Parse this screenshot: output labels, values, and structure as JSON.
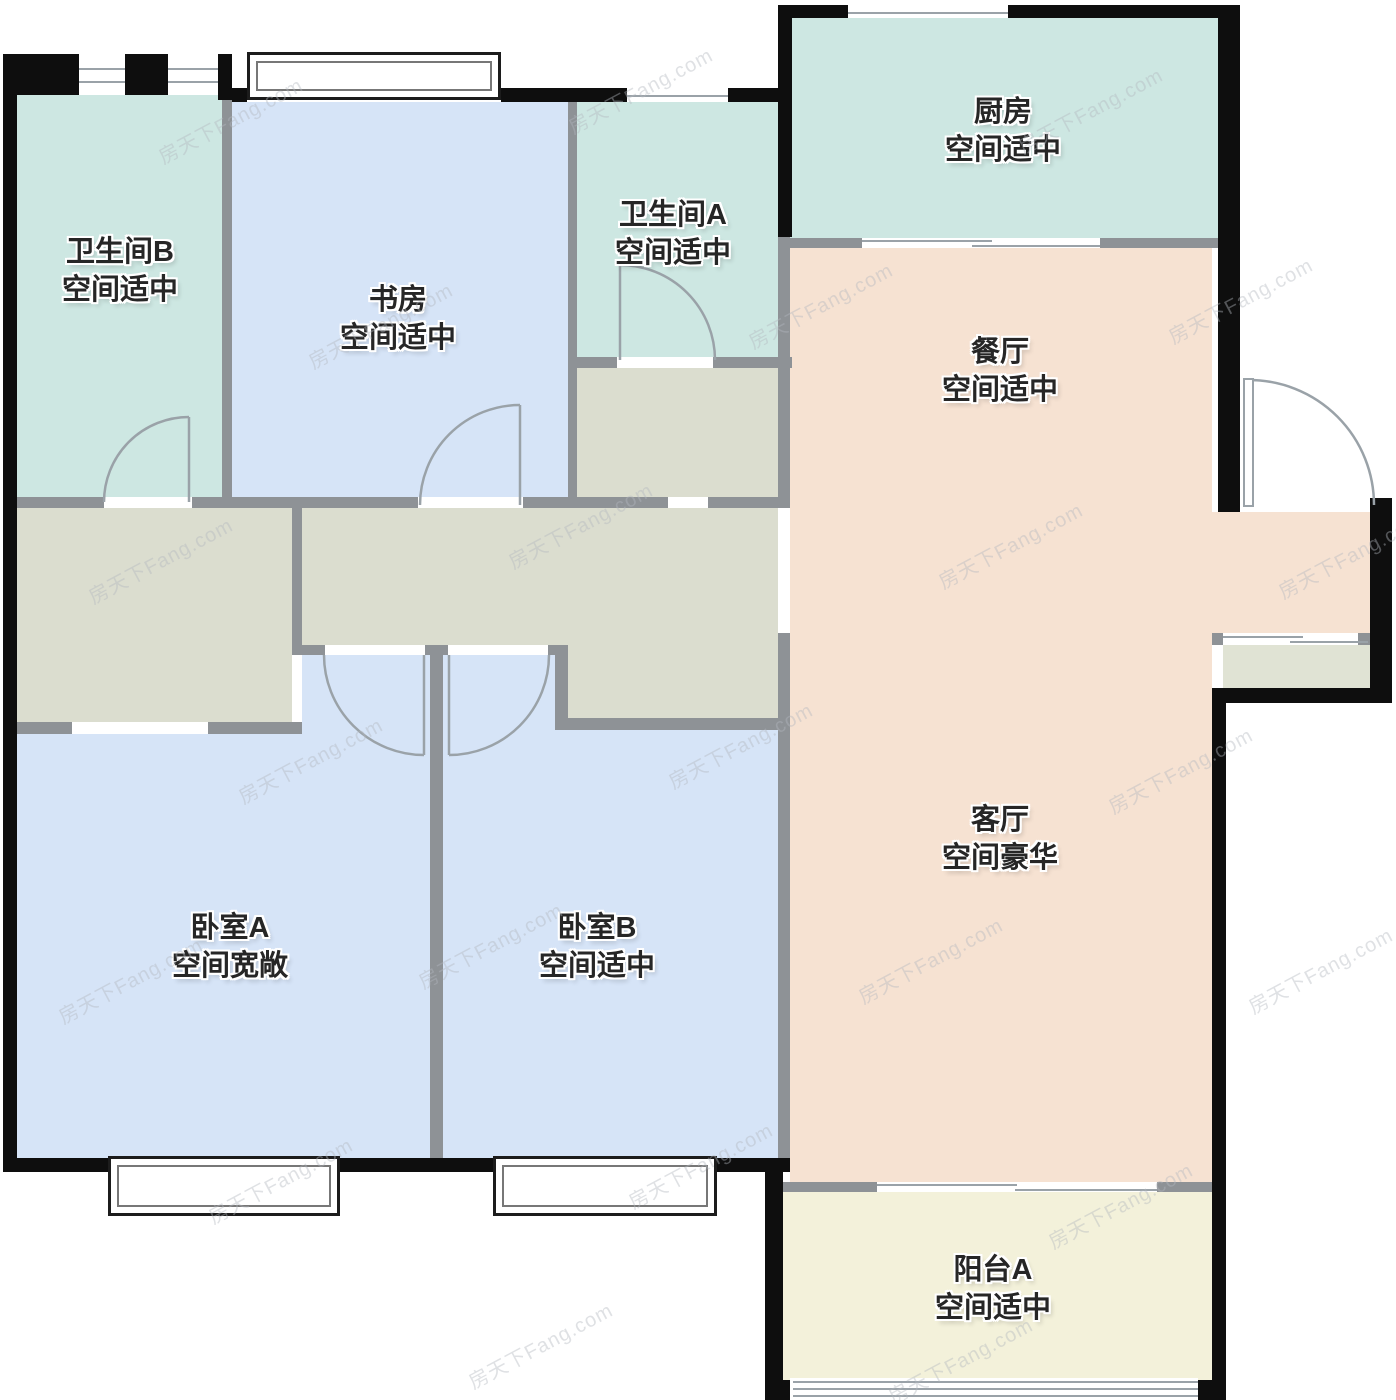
{
  "floorplan": {
    "watermark": "房天下Fang.com",
    "rooms": [
      {
        "id": "bathroom-b",
        "name": "卫生间B",
        "size_note": "空间适中",
        "fill": "#cde7e2"
      },
      {
        "id": "study",
        "name": "书房",
        "size_note": "空间适中",
        "fill": "#d6e4f7"
      },
      {
        "id": "bathroom-a",
        "name": "卫生间A",
        "size_note": "空间适中",
        "fill": "#cde7e2"
      },
      {
        "id": "kitchen",
        "name": "厨房",
        "size_note": "空间适中",
        "fill": "#cde7e2"
      },
      {
        "id": "dining",
        "name": "餐厅",
        "size_note": "空间适中",
        "fill": "#f6e2d2"
      },
      {
        "id": "living",
        "name": "客厅",
        "size_note": "空间豪华",
        "fill": "#f6e2d2"
      },
      {
        "id": "bedroom-a",
        "name": "卧室A",
        "size_note": "空间宽敞",
        "fill": "#d6e4f7"
      },
      {
        "id": "bedroom-b",
        "name": "卧室B",
        "size_note": "空间适中",
        "fill": "#d6e4f7"
      },
      {
        "id": "balcony-a",
        "name": "阳台A",
        "size_note": "空间适中",
        "fill": "#f3f1da"
      }
    ],
    "colors": {
      "exterior_wall": "#0e0e0e",
      "partition_wall": "#8e9296",
      "hallway": "#dbddcf",
      "entry_porch": "#e0e3d4",
      "door_line": "#9aa2a8"
    }
  }
}
